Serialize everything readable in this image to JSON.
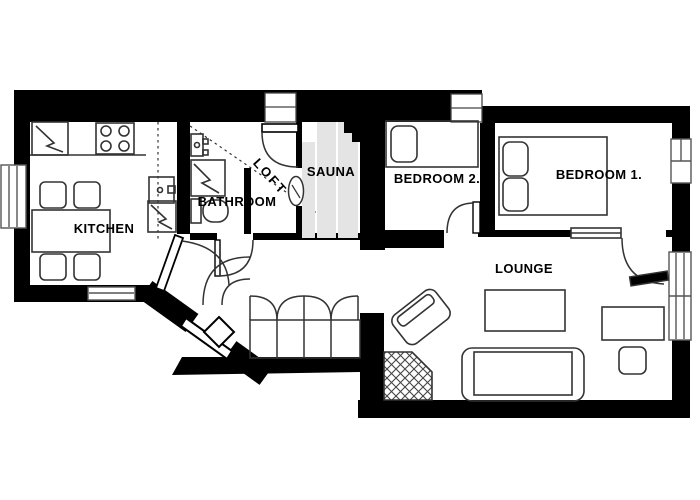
{
  "plan": {
    "type": "apartment-floor-plan",
    "rooms": [
      {
        "id": "kitchen",
        "label": "KITCHEN"
      },
      {
        "id": "bathroom",
        "label": "BATHROOM"
      },
      {
        "id": "loft",
        "label": "LOFT"
      },
      {
        "id": "sauna",
        "label": "SAUNA"
      },
      {
        "id": "bedroom2",
        "label": "BEDROOM 2."
      },
      {
        "id": "bedroom1",
        "label": "BEDROOM 1."
      },
      {
        "id": "lounge",
        "label": "LOUNGE"
      }
    ],
    "colors": {
      "wall": "#000000",
      "floor": "#ffffff",
      "sauna_bench": "#e4e4e4",
      "furniture_line": "#333333"
    },
    "features": [
      "kitchen table with four chairs",
      "stove with four burners",
      "fridge",
      "kitchen sink",
      "bathroom shower and toilet and basin",
      "sauna benches and heater",
      "double bed bedroom 1",
      "single bed bedroom 2",
      "sofa",
      "coffee table",
      "armchair",
      "desk",
      "stool",
      "corner fireplace",
      "four-door hallway wardrobe",
      "diagonal entrance door",
      "windows",
      "loft dashed outline"
    ]
  }
}
